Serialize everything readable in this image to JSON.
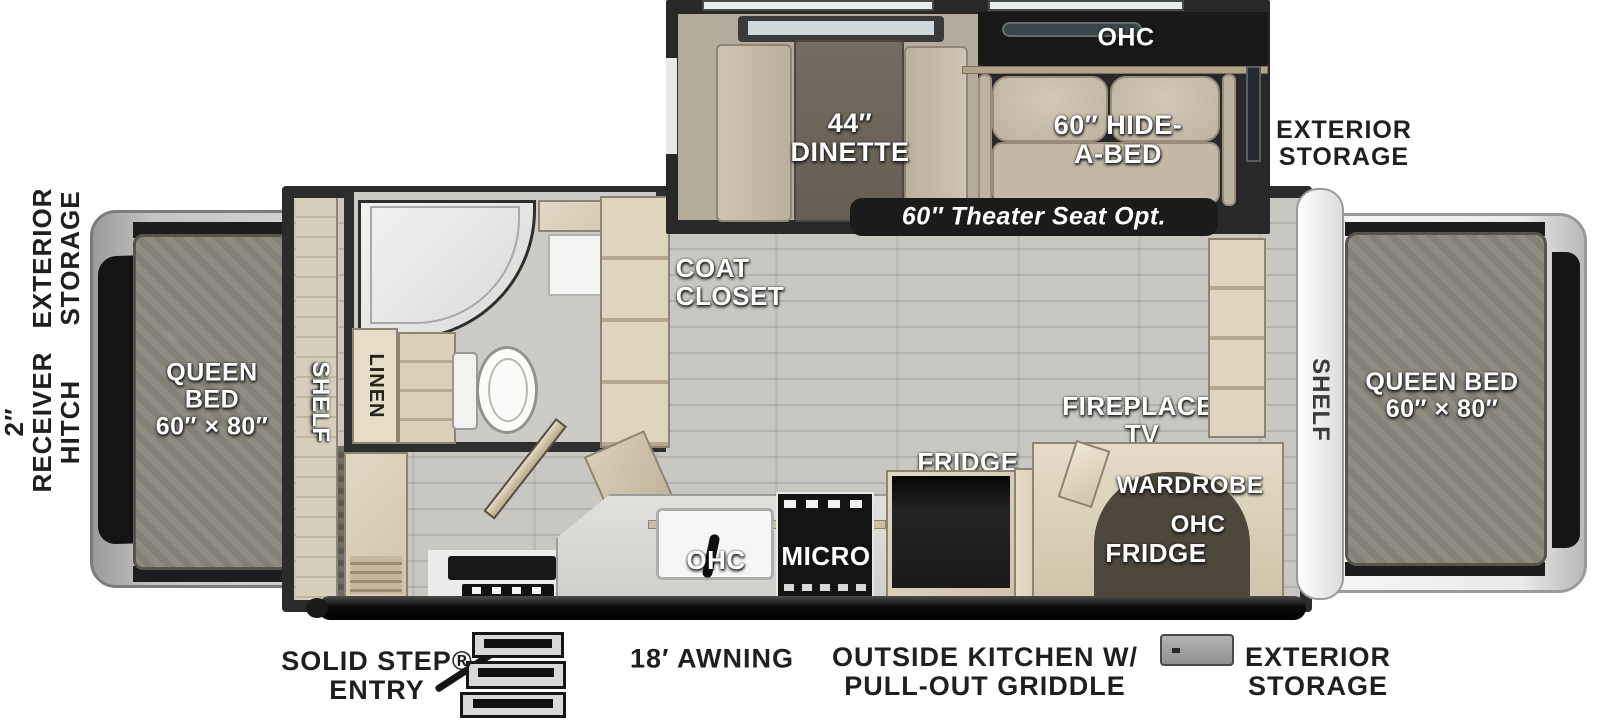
{
  "title": "Travel trailer floorplan - top view",
  "colors": {
    "floor": "#c8c7c1",
    "walls": "#2b2b2b",
    "cabinet": "#d8cfba",
    "mattress": "#8a877d",
    "label_white": "#ffffff",
    "label_black": "#1e1f21",
    "badge_bg": "#1b1b1b"
  },
  "exterior": {
    "left_storage": {
      "lines": [
        "EXTERIOR",
        "STORAGE"
      ]
    },
    "hitch": {
      "lines": [
        "2″",
        "RECEIVER",
        "HITCH"
      ]
    },
    "top_right_storage": {
      "lines": [
        "EXTERIOR",
        "STORAGE"
      ]
    },
    "bottom_right_storage": {
      "lines": [
        "EXTERIOR",
        "STORAGE"
      ]
    },
    "solid_step": {
      "lines": [
        "SOLID STEP®",
        "ENTRY"
      ]
    },
    "awning": "18′ AWNING",
    "outside_kitchen": {
      "lines": [
        "OUTSIDE KITCHEN W/",
        "PULL-OUT GRIDDLE"
      ]
    }
  },
  "slide_out": {
    "ohc": "OHC",
    "dinette": {
      "lines": [
        "44″",
        "DINETTE"
      ]
    },
    "hide_a_bed": {
      "lines": [
        "60″ HIDE-",
        "A-BED"
      ]
    },
    "theater_badge": "60″ Theater Seat Opt."
  },
  "bedroom_left": {
    "bed": {
      "lines": [
        "QUEEN",
        "BED",
        "60″ × 80″"
      ]
    },
    "shelf": "SHELF"
  },
  "bedroom_right": {
    "bed": {
      "lines": [
        "QUEEN BED",
        "60″ × 80″"
      ]
    },
    "shelf": "SHELF"
  },
  "bathroom": {
    "linen": "LINEN"
  },
  "living": {
    "coat_closet": {
      "lines": [
        "COAT",
        "CLOSET"
      ]
    },
    "fireplace_tv": {
      "lines": [
        "FIREPLACE/",
        "TV"
      ]
    },
    "wardrobe": "WARDROBE",
    "wardrobe_ohc": "OHC",
    "wardrobe_fridge": "FRIDGE"
  },
  "kitchen": {
    "ohc": "OHC",
    "micro": "MICRO",
    "fridge": "FRIDGE",
    "pantry": "PANTRY"
  }
}
